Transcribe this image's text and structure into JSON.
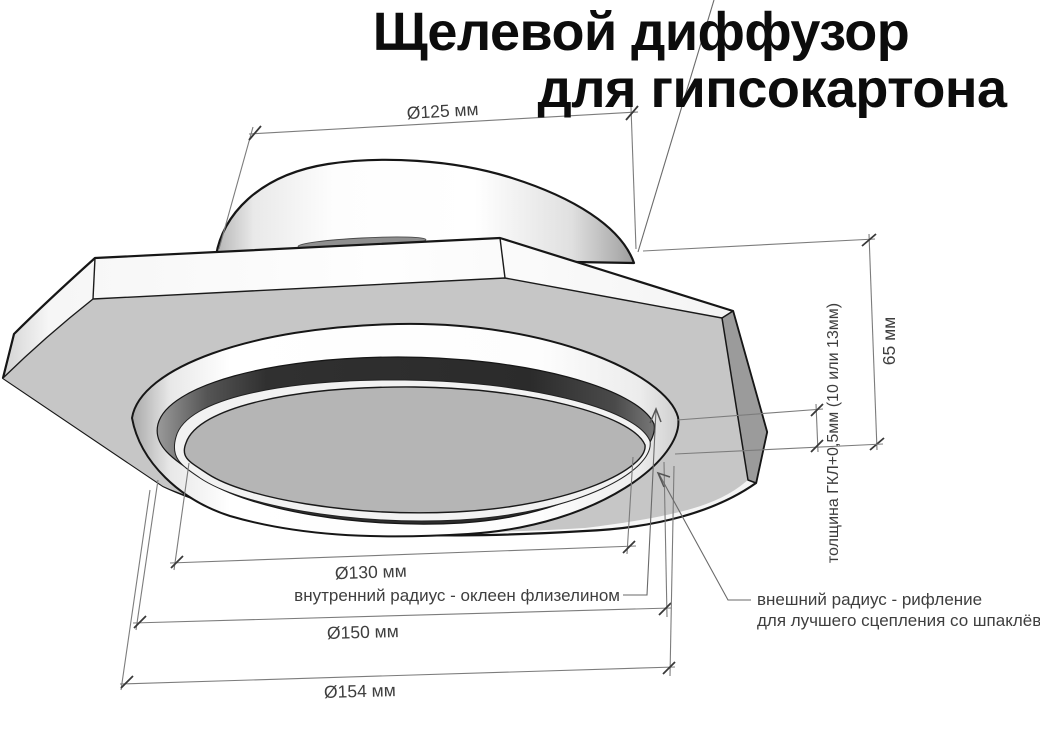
{
  "title": {
    "line1": "Щелевой диффузор",
    "line2": "для гипсокартона"
  },
  "dimensions": {
    "neck_diameter": "Ø125 мм",
    "height": "65 мм",
    "panel_thickness": "толщина ГКЛ+0,5мм (10 или 13мм)",
    "inner_diameter": "Ø130 мм",
    "flange_diameter": "Ø150 мм",
    "outer_diameter": "Ø154 мм"
  },
  "annotations": {
    "inner_radius": "внутренний радиус - оклеен флизелином",
    "outer_radius_line1": "внешний радиус - рифление",
    "outer_radius_line2": "для лучшего сцепления со шпаклёвкой"
  },
  "colors": {
    "background": "#ffffff",
    "outline": "#161616",
    "plate_gray": "#c6c6c6",
    "disc_gray": "#b5b5b5",
    "chamfer_gray": "#9b9b9b",
    "slot_dark": "#2e2e2e",
    "sliver_gray": "#8f8f8f",
    "disc_lip": "#f2f2f2",
    "dim_line": "#7c7c7c",
    "dim_text": "#3e3e3e",
    "title_color": "#0c0c0c"
  }
}
